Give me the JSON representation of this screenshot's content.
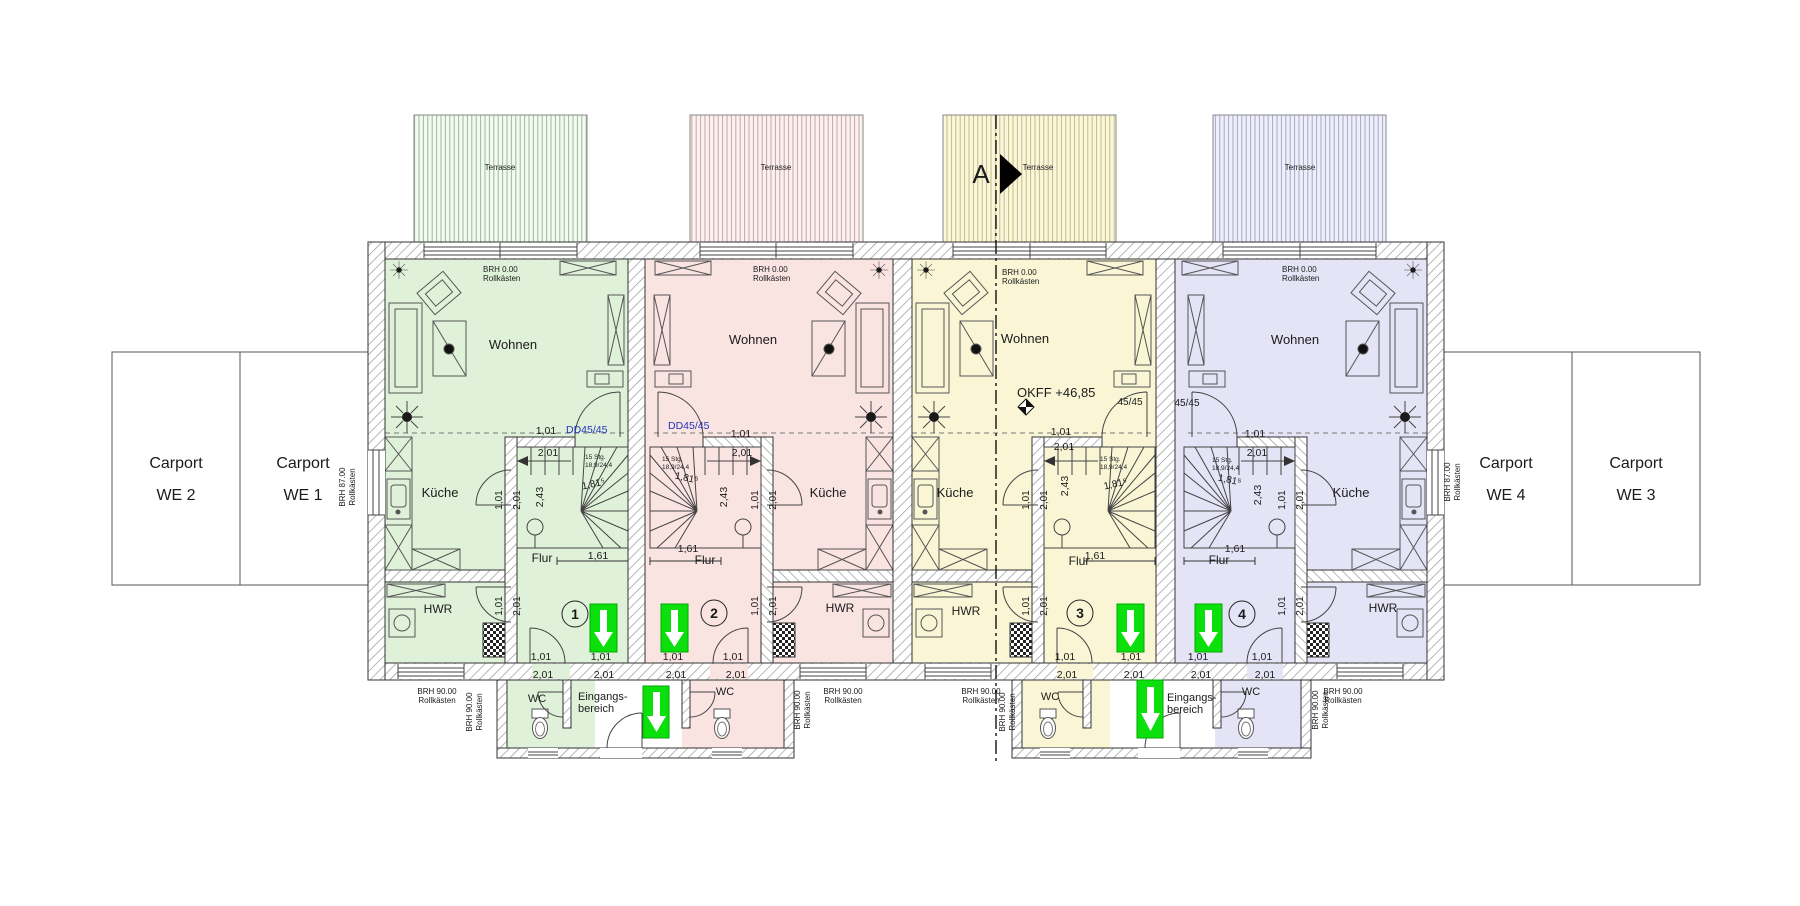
{
  "plan": {
    "carports": {
      "we2": {
        "l1": "Carport",
        "l2": "WE 2"
      },
      "we1": {
        "l1": "Carport",
        "l2": "WE 1"
      },
      "we4": {
        "l1": "Carport",
        "l2": "WE 4"
      },
      "we3": {
        "l1": "Carport",
        "l2": "WE 3"
      }
    },
    "units": [
      {
        "number": "1"
      },
      {
        "number": "2"
      },
      {
        "number": "3"
      },
      {
        "number": "4"
      }
    ],
    "rooms": {
      "wohnen": "Wohnen",
      "kueche": "Küche",
      "flur": "Flur",
      "hwr": "HWR",
      "wc": "WC"
    },
    "entrance": {
      "l1": "Eingangs-",
      "l2": "bereich"
    },
    "terrace": "Terrasse",
    "section": "A",
    "level": "OKFF +46,85",
    "notes": {
      "brh0": "BRH 0.00",
      "brh87": "BRH 87.00",
      "brh90": "BRH 90.00",
      "roll": "Rollkästen",
      "stair1": "15 Stg.",
      "stair2": "18,9/24,4",
      "dd": "DD45/45",
      "col": "45/45"
    },
    "dims": {
      "w": "1,01",
      "h": "2,01",
      "run": "2,43",
      "diag": "1,81⁵",
      "flur": "1,61"
    },
    "colors": {
      "unit1": "#dff2d9",
      "unit2": "#fae4e2",
      "unit3": "#faf6d5",
      "unit4": "#e4e4f6",
      "arrow": "#0ce00c",
      "blue": "#2233bb"
    }
  }
}
